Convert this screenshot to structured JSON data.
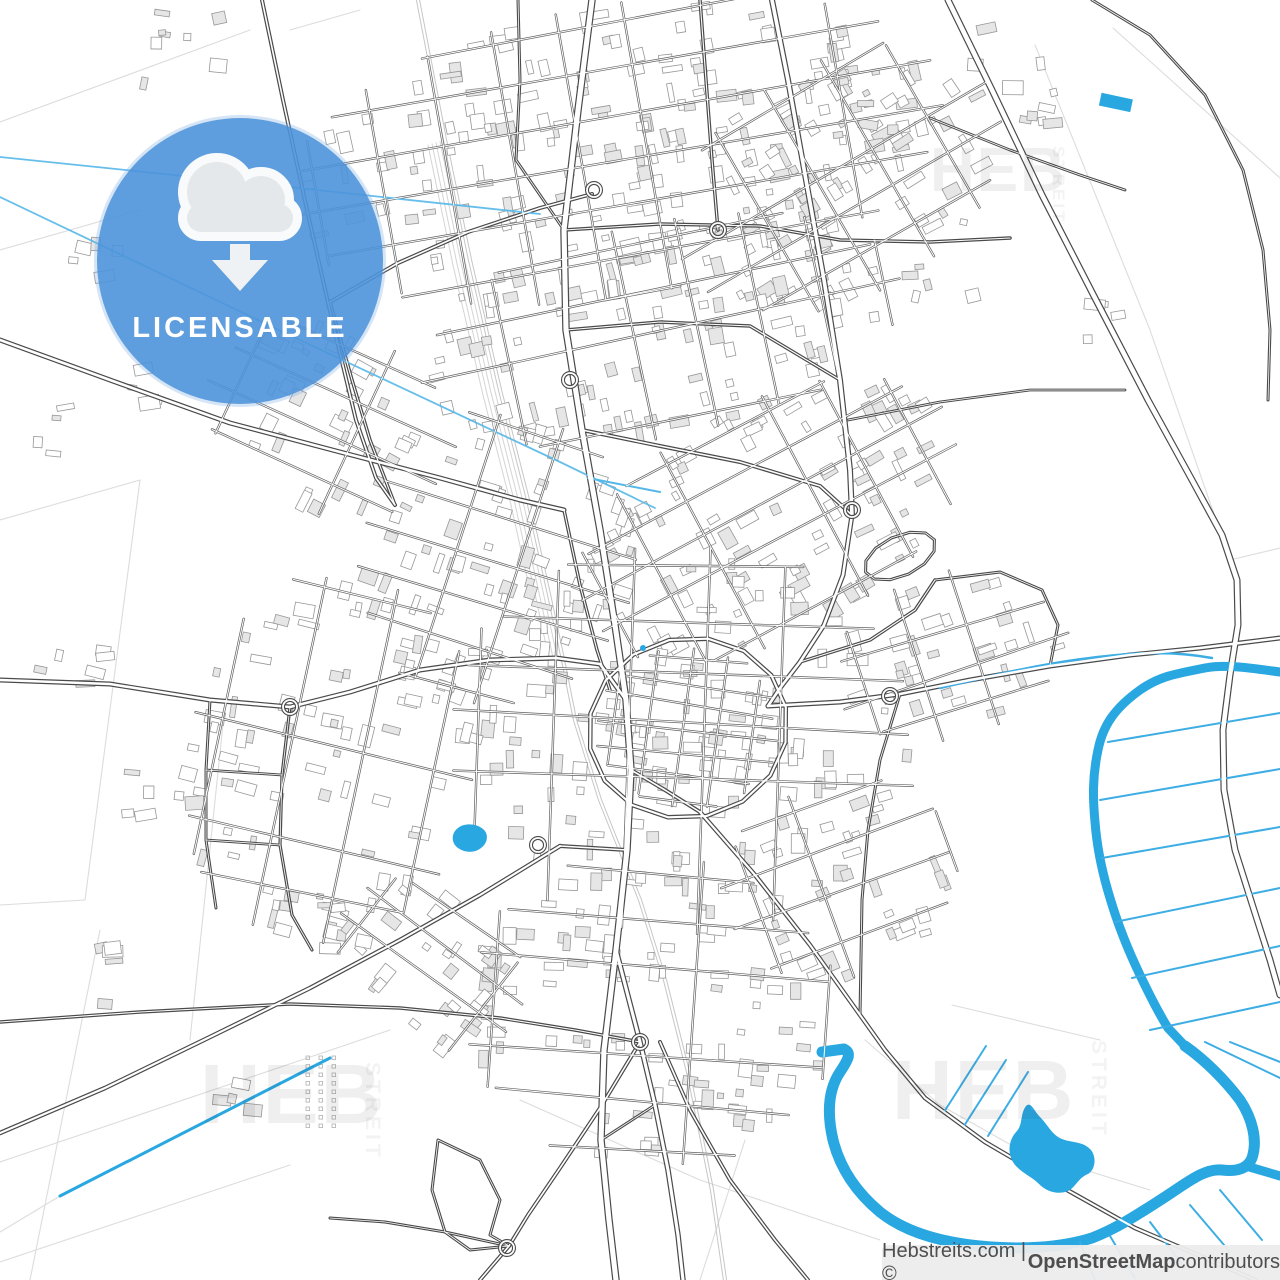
{
  "badge": {
    "label": "LICENSABLE",
    "icon": "cloud-download-icon",
    "circle_color": "#4E93DA",
    "cloud_fill": "#E5E8EA",
    "cloud_stroke": "#F8FAFB",
    "arrow_color": "#EEF2F4",
    "label_color": "#FFFFFF"
  },
  "watermark": {
    "primary": "HEB",
    "secondary": "STREIT"
  },
  "attribution": {
    "prefix": "Hebstreits.com | © ",
    "osm": "OpenStreetMap",
    "suffix": " contributors",
    "bar_color": "rgba(236,236,236,0.95)",
    "text_color": "#4E4E4E"
  },
  "map_colors": {
    "background": "#FFFFFF",
    "water": "#29A7E1",
    "drain": "#3DADE4",
    "stream": "#55B7E8",
    "road_casing": "#4A4A4A",
    "road_fill": "#FFFFFF",
    "minor_casing": "#606060",
    "building_stroke": "#979797",
    "building_fill_light": "#FFFFFF",
    "building_fill_gray": "#E6E6E6",
    "field_line": "#DCDCDC",
    "rail": "#C6C6C6",
    "rail_yard": "#D4D4D4"
  }
}
